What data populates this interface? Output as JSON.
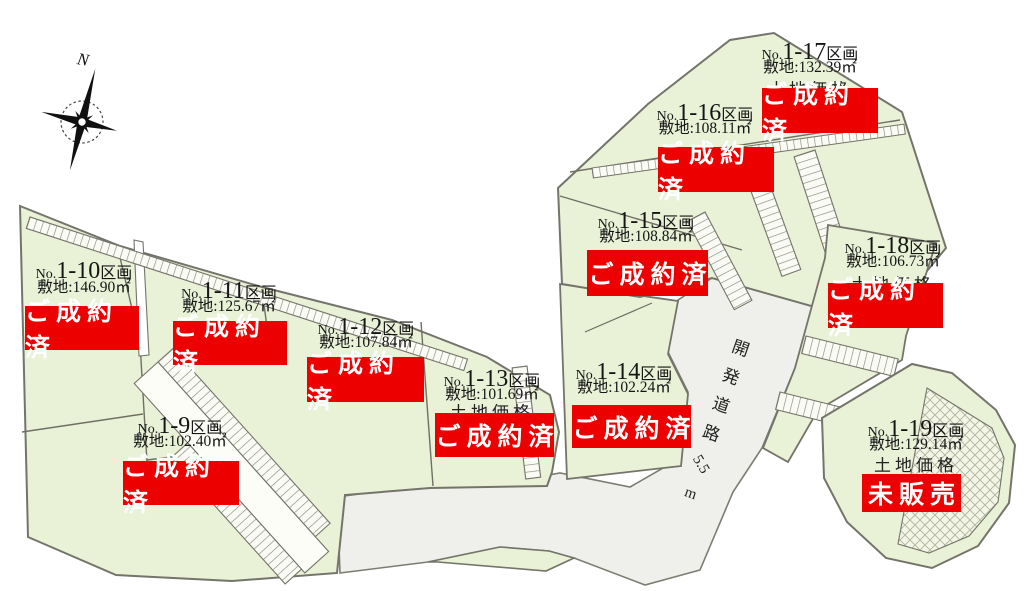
{
  "map": {
    "compass_label": "N",
    "road": {
      "name": "開発道路",
      "width_label": "5.5",
      "unit": "m"
    },
    "price_label": "土地価格",
    "colors": {
      "plot_green": "#e9f1d7",
      "road_gray": "#efefeb",
      "banner_red": "#ed0000",
      "border_dark": "#6f6f64",
      "hatch_white": "#fbfbf5"
    }
  },
  "plots": [
    {
      "id": "1-9",
      "no": "No.",
      "num": "1-9",
      "suffix": "区画",
      "area": "敷地:102.40㎡",
      "status": "ご成約済"
    },
    {
      "id": "1-10",
      "no": "No.",
      "num": "1-10",
      "suffix": "区画",
      "area": "敷地:146.90㎡",
      "status": "ご成約済"
    },
    {
      "id": "1-11",
      "no": "No.",
      "num": "1-11",
      "suffix": "区画",
      "area": "敷地:125.67㎡",
      "status": "ご成約済"
    },
    {
      "id": "1-12",
      "no": "No.",
      "num": "1-12",
      "suffix": "区画",
      "area": "敷地:107.84㎡",
      "status": "ご成約済"
    },
    {
      "id": "1-13",
      "no": "No.",
      "num": "1-13",
      "suffix": "区画",
      "area": "敷地:101.69㎡",
      "status": "ご成約済",
      "price": "土地価格"
    },
    {
      "id": "1-14",
      "no": "No.",
      "num": "1-14",
      "suffix": "区画",
      "area": "敷地:102.24㎡",
      "status": "ご成約済"
    },
    {
      "id": "1-15",
      "no": "No.",
      "num": "1-15",
      "suffix": "区画",
      "area": "敷地:108.84㎡",
      "status": "ご成約済"
    },
    {
      "id": "1-16",
      "no": "No.",
      "num": "1-16",
      "suffix": "区画",
      "area": "敷地:108.11㎡",
      "status": "ご成約済"
    },
    {
      "id": "1-17",
      "no": "No.",
      "num": "1-17",
      "suffix": "区画",
      "area": "敷地:132.39㎡",
      "status": "ご成約済",
      "price": "土地価格"
    },
    {
      "id": "1-18",
      "no": "No.",
      "num": "1-18",
      "suffix": "区画",
      "area": "敷地:106.73㎡",
      "status": "ご成約済",
      "price": "土地価格"
    },
    {
      "id": "1-19",
      "no": "No.",
      "num": "1-19",
      "suffix": "区画",
      "area": "敷地:129.14㎡",
      "status": "未販売",
      "price": "土地価格"
    }
  ]
}
